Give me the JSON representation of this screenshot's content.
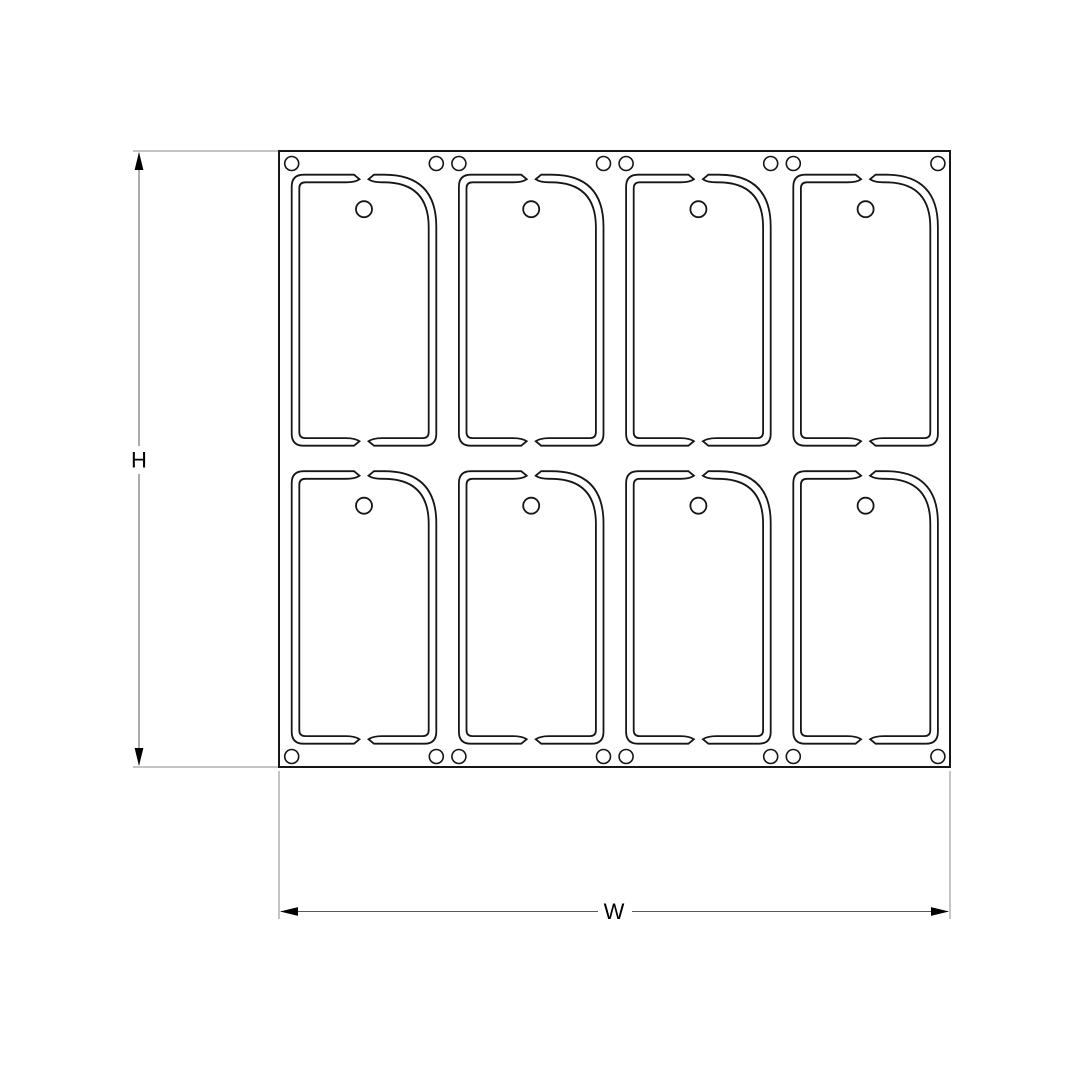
{
  "drawing": {
    "title": "tag-sheet-panel-drawing",
    "labels": {
      "height_dim": "H",
      "width_dim": "W"
    },
    "grid": {
      "rows": 2,
      "columns": 4,
      "tag_count": 8
    },
    "holes": {
      "hang_holes_per_tag": 1,
      "top_edge_holes": 8,
      "bottom_edge_holes": 8
    },
    "colors": {
      "background": "#ffffff",
      "cut_line": "#161616",
      "panel_outline": "#161616",
      "dimension_line": "#5a5a5a",
      "extension_line": "#8a8a8a",
      "arrow": "#000000",
      "text": "#000000"
    }
  }
}
